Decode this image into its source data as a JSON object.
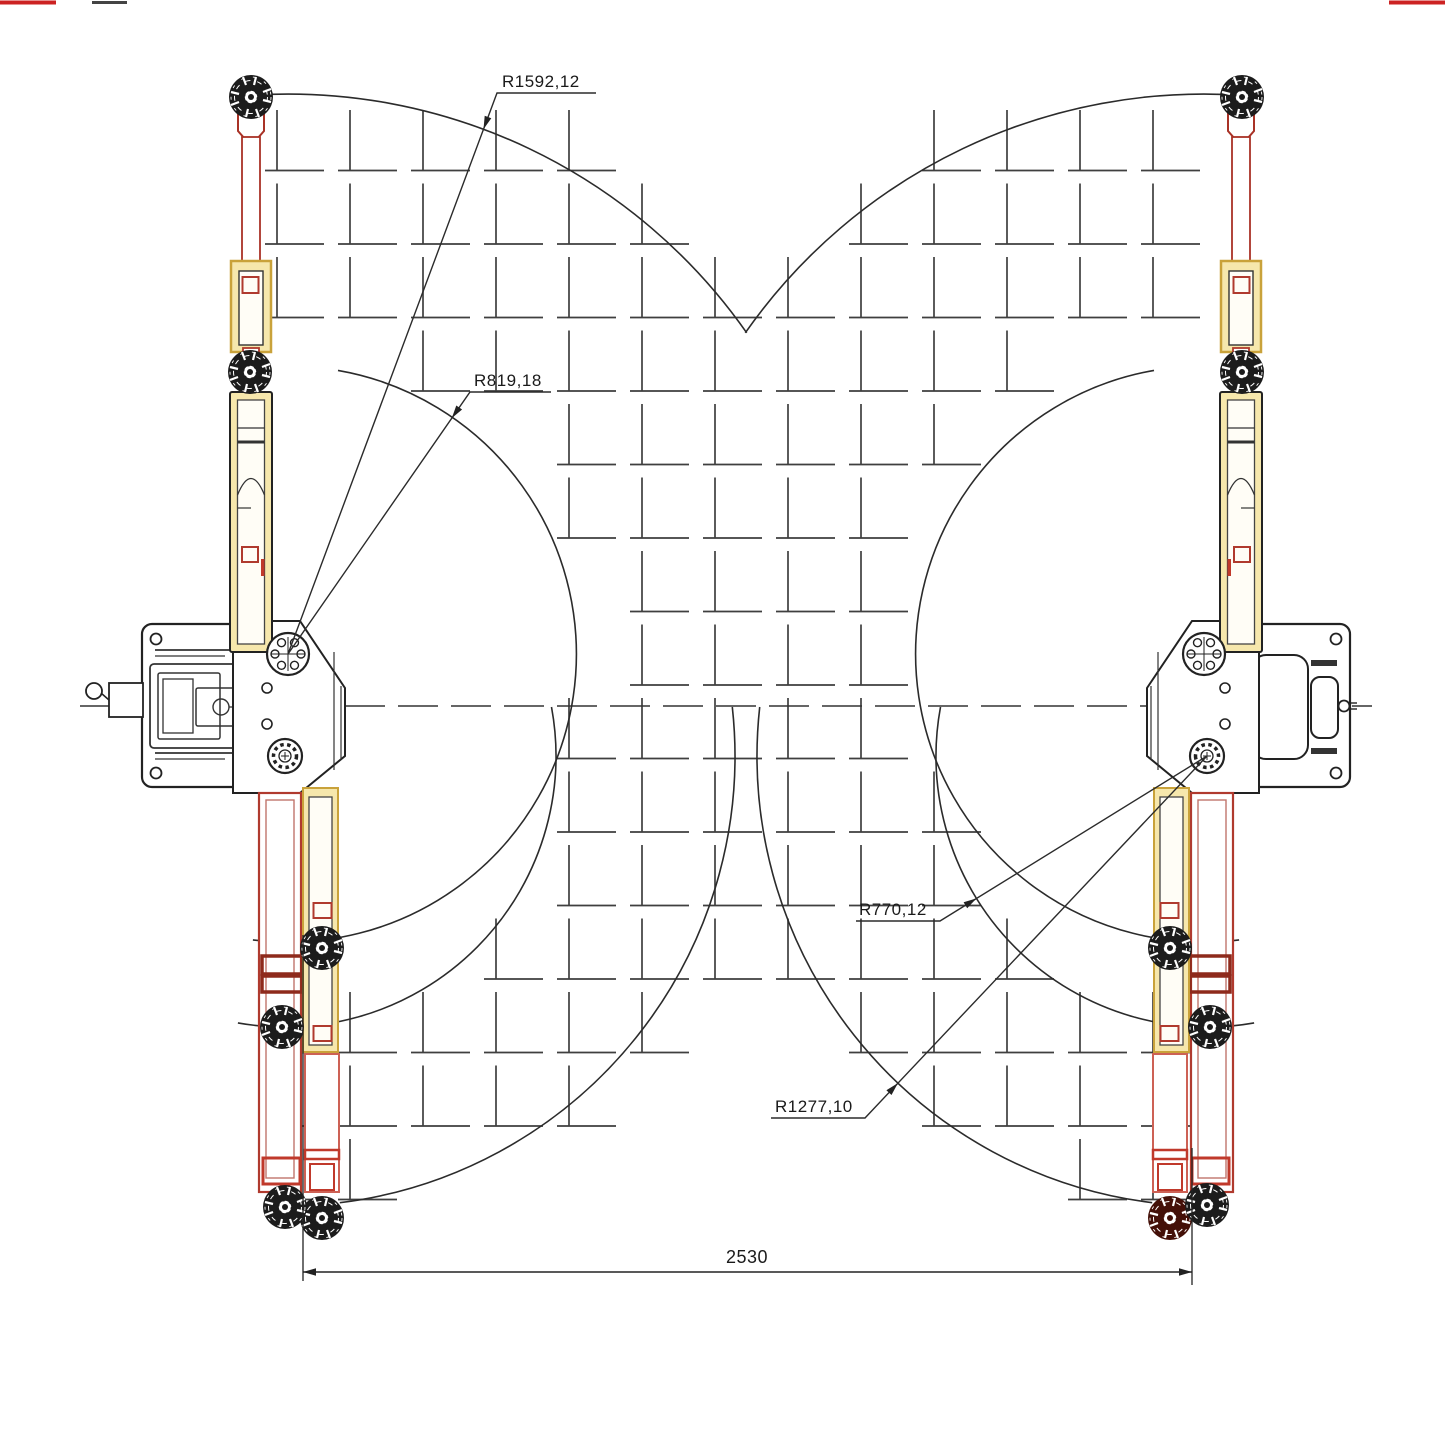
{
  "drawing": {
    "type": "two-post-lift-plan-view",
    "labels": {
      "r1592": "R1592,12",
      "r819": "R819,18",
      "r770": "R770,12",
      "r1277": "R1277,10",
      "width_dim": "2530"
    },
    "radii_mm": [
      1592.12,
      819.18,
      770.12,
      1277.1
    ],
    "post_spacing_mm": 2530,
    "colors": {
      "line": "#2b2b2b",
      "grid": "#3f3f3f",
      "arm_red": "#b03a2e",
      "arm_dark_red": "#8e2a1c",
      "arm_pink": "#cd6155",
      "sleeve_yellow_fill": "#f6e7ac",
      "sleeve_yellow_edge": "#c9a23a",
      "wheel_black": "#1c1c1c",
      "wheel_maroon": "#441008",
      "background": "#ffffff"
    }
  }
}
